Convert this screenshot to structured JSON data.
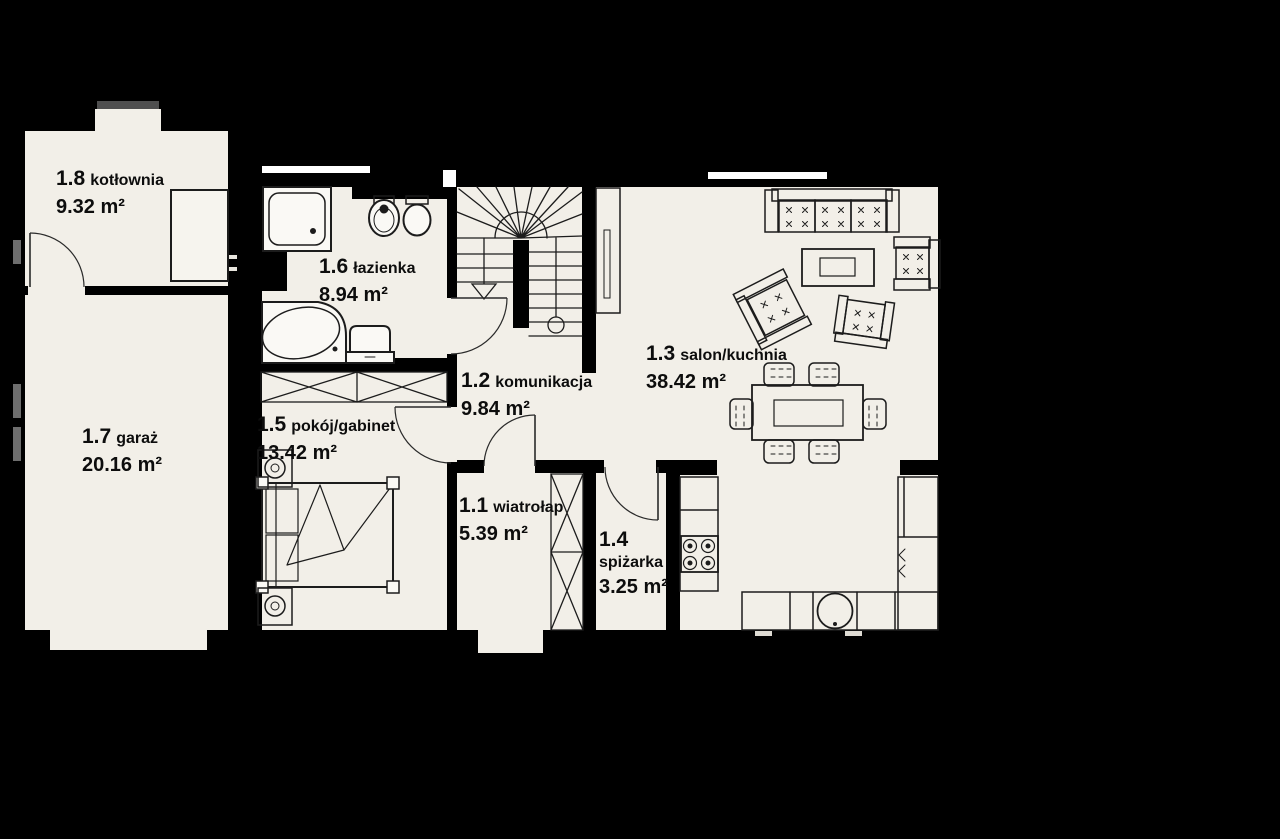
{
  "canvas": {
    "width": 1280,
    "height": 839,
    "background_color": "#000000",
    "floor_color": "#f2efe8",
    "wall_color": "#000000",
    "window_color": "#ffffff",
    "side_window_color": "#6e6e6e",
    "furniture_line_color": "#1c1c1c",
    "text_color": "#0d0d0d"
  },
  "rooms": [
    {
      "number": "1.1",
      "name": "wiatrołap",
      "area": "5.39 m²"
    },
    {
      "number": "1.2",
      "name": "komunikacja",
      "area": "9.84 m²"
    },
    {
      "number": "1.3",
      "name": "salon/kuchnia",
      "area": "38.42 m²"
    },
    {
      "number": "1.4",
      "name": "spiżarka",
      "area": "3.25 m²"
    },
    {
      "number": "1.5",
      "name": "pokój/gabinet",
      "area": "13.42 m²"
    },
    {
      "number": "1.6",
      "name": "łazienka",
      "area": "8.94 m²"
    },
    {
      "number": "1.7",
      "name": "garaż",
      "area": "20.16 m²"
    },
    {
      "number": "1.8",
      "name": "kotłownia",
      "area": "9.32 m²"
    }
  ],
  "furniture": [
    "winder-stairs",
    "sofa",
    "armchair",
    "coffee-table",
    "tv-cabinet",
    "dining-table",
    "dining-chair",
    "bed",
    "nightstand",
    "wardrobe",
    "shower",
    "corner-bathtub",
    "washbasin",
    "toilet",
    "bidet",
    "boiler",
    "stove",
    "kitchen-sink",
    "kitchen-counter",
    "tall-cabinet",
    "chimney",
    "entrance-recess",
    "garage-door-recess"
  ]
}
